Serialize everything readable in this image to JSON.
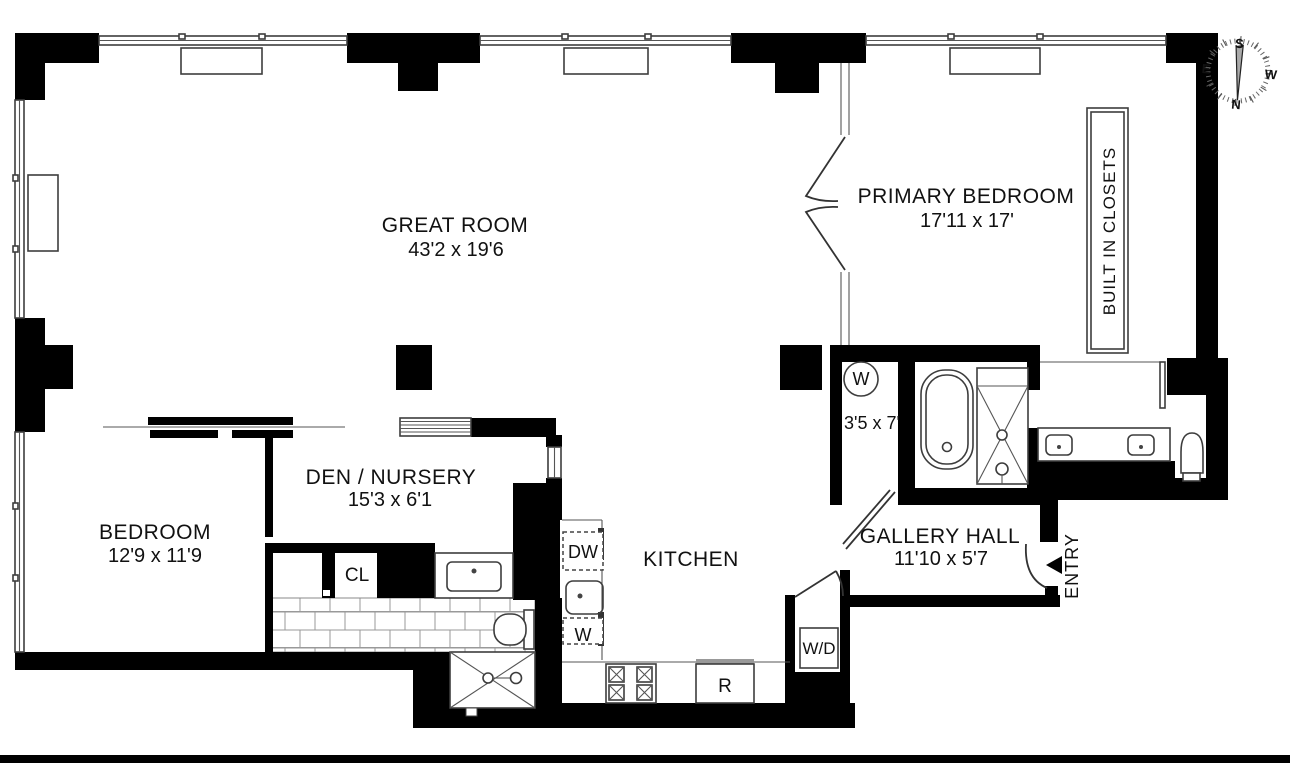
{
  "plan": {
    "rooms": {
      "great_room": {
        "name": "GREAT ROOM",
        "dims": "43'2 x 19'6"
      },
      "primary_bedroom": {
        "name": "PRIMARY BEDROOM",
        "dims": "17'11 x 17'"
      },
      "bedroom": {
        "name": "BEDROOM",
        "dims": "12'9 x 11'9"
      },
      "den_nursery": {
        "name": "DEN / NURSERY",
        "dims": "15'3 x 6'1"
      },
      "kitchen": {
        "name": "KITCHEN"
      },
      "gallery_hall": {
        "name": "GALLERY HALL",
        "dims": "11'10 x 5'7"
      },
      "laundry_closet": {
        "dims": "3'5 x 7'"
      },
      "built_in_closets": {
        "name": "BUILT IN CLOSETS"
      },
      "entry": {
        "name": "ENTRY"
      },
      "closet": {
        "name": "CL"
      }
    },
    "appliances": {
      "laundry_washer": "W",
      "dishwasher": "DW",
      "kitchen_w": "W",
      "refrigerator": "R",
      "washer_dryer": "W/D"
    },
    "compass": {
      "north": "N",
      "south": "S",
      "east": "E",
      "west": "W"
    },
    "colors": {
      "wall": "#000000",
      "background": "#ffffff",
      "thin_line": "#3d3d3d"
    }
  }
}
